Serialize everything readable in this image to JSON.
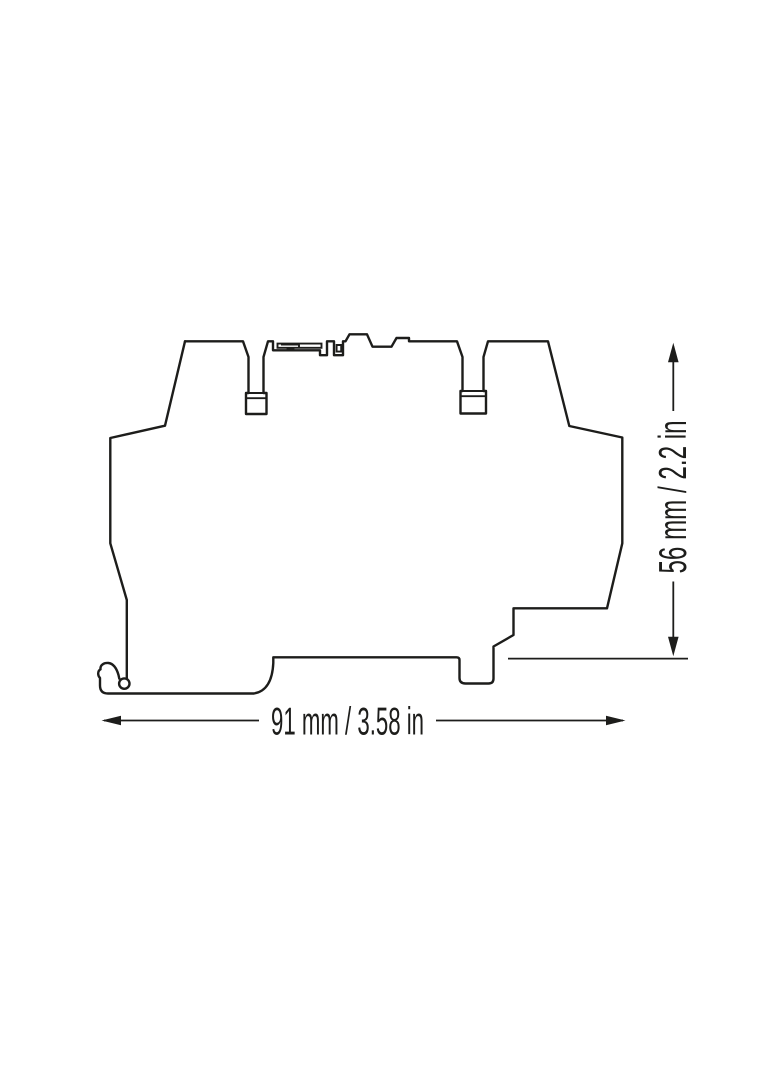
{
  "drawing": {
    "background_color": "#ffffff",
    "line_color": "#1d1d1b",
    "width_dimension": {
      "label": "91 mm / 3.58 in",
      "mm": 91,
      "inch": 3.58
    },
    "height_dimension": {
      "label": "56 mm / 2.2 in",
      "mm": 56,
      "inch": 2.2
    }
  }
}
